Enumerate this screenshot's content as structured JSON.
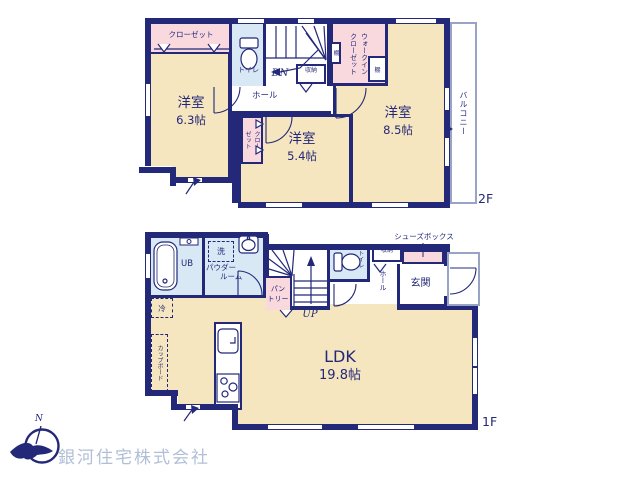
{
  "colors": {
    "wall_navy": "#232878",
    "room_cream": "#f5e6c0",
    "closet_pink": "#f9d9de",
    "bath_blue": "#d9e8f5",
    "outline_gray": "#98a3c6",
    "logo_text_gray": "#b1bfd6"
  },
  "floor2": {
    "label": "2F",
    "closet63": "クローゼット",
    "room63": {
      "name": "洋室",
      "size": "6.3帖"
    },
    "toilet": "トイレ",
    "dn": "DN",
    "storage": "収納",
    "wic": {
      "line1": "ウォークイン",
      "line2": "クローゼット"
    },
    "shelf": "棚",
    "hall": "ホール",
    "room85": {
      "name": "洋室",
      "size": "8.5帖"
    },
    "closet54": {
      "line1": "クロー",
      "line2": "ゼット"
    },
    "room54": {
      "name": "洋室",
      "size": "5.4帖"
    },
    "balcony": "バルコニー"
  },
  "floor1": {
    "label": "1F",
    "ub": "UB",
    "wash": "洗",
    "powder": {
      "line1": "パウダー",
      "line2": "ルーム"
    },
    "pantry": {
      "line1": "パン",
      "line2": "トリー"
    },
    "up": "UP",
    "toilet": "トイレ",
    "storage": "収納",
    "shoebox": "シューズボックス",
    "hall": "ホール",
    "genkan": "玄関",
    "fridge": "冷",
    "cupboard": "カップボード",
    "ldk": {
      "name": "LDK",
      "size": "19.8帖"
    }
  },
  "footer": {
    "company": "銀河住宅株式会社",
    "compass_n": "N"
  }
}
